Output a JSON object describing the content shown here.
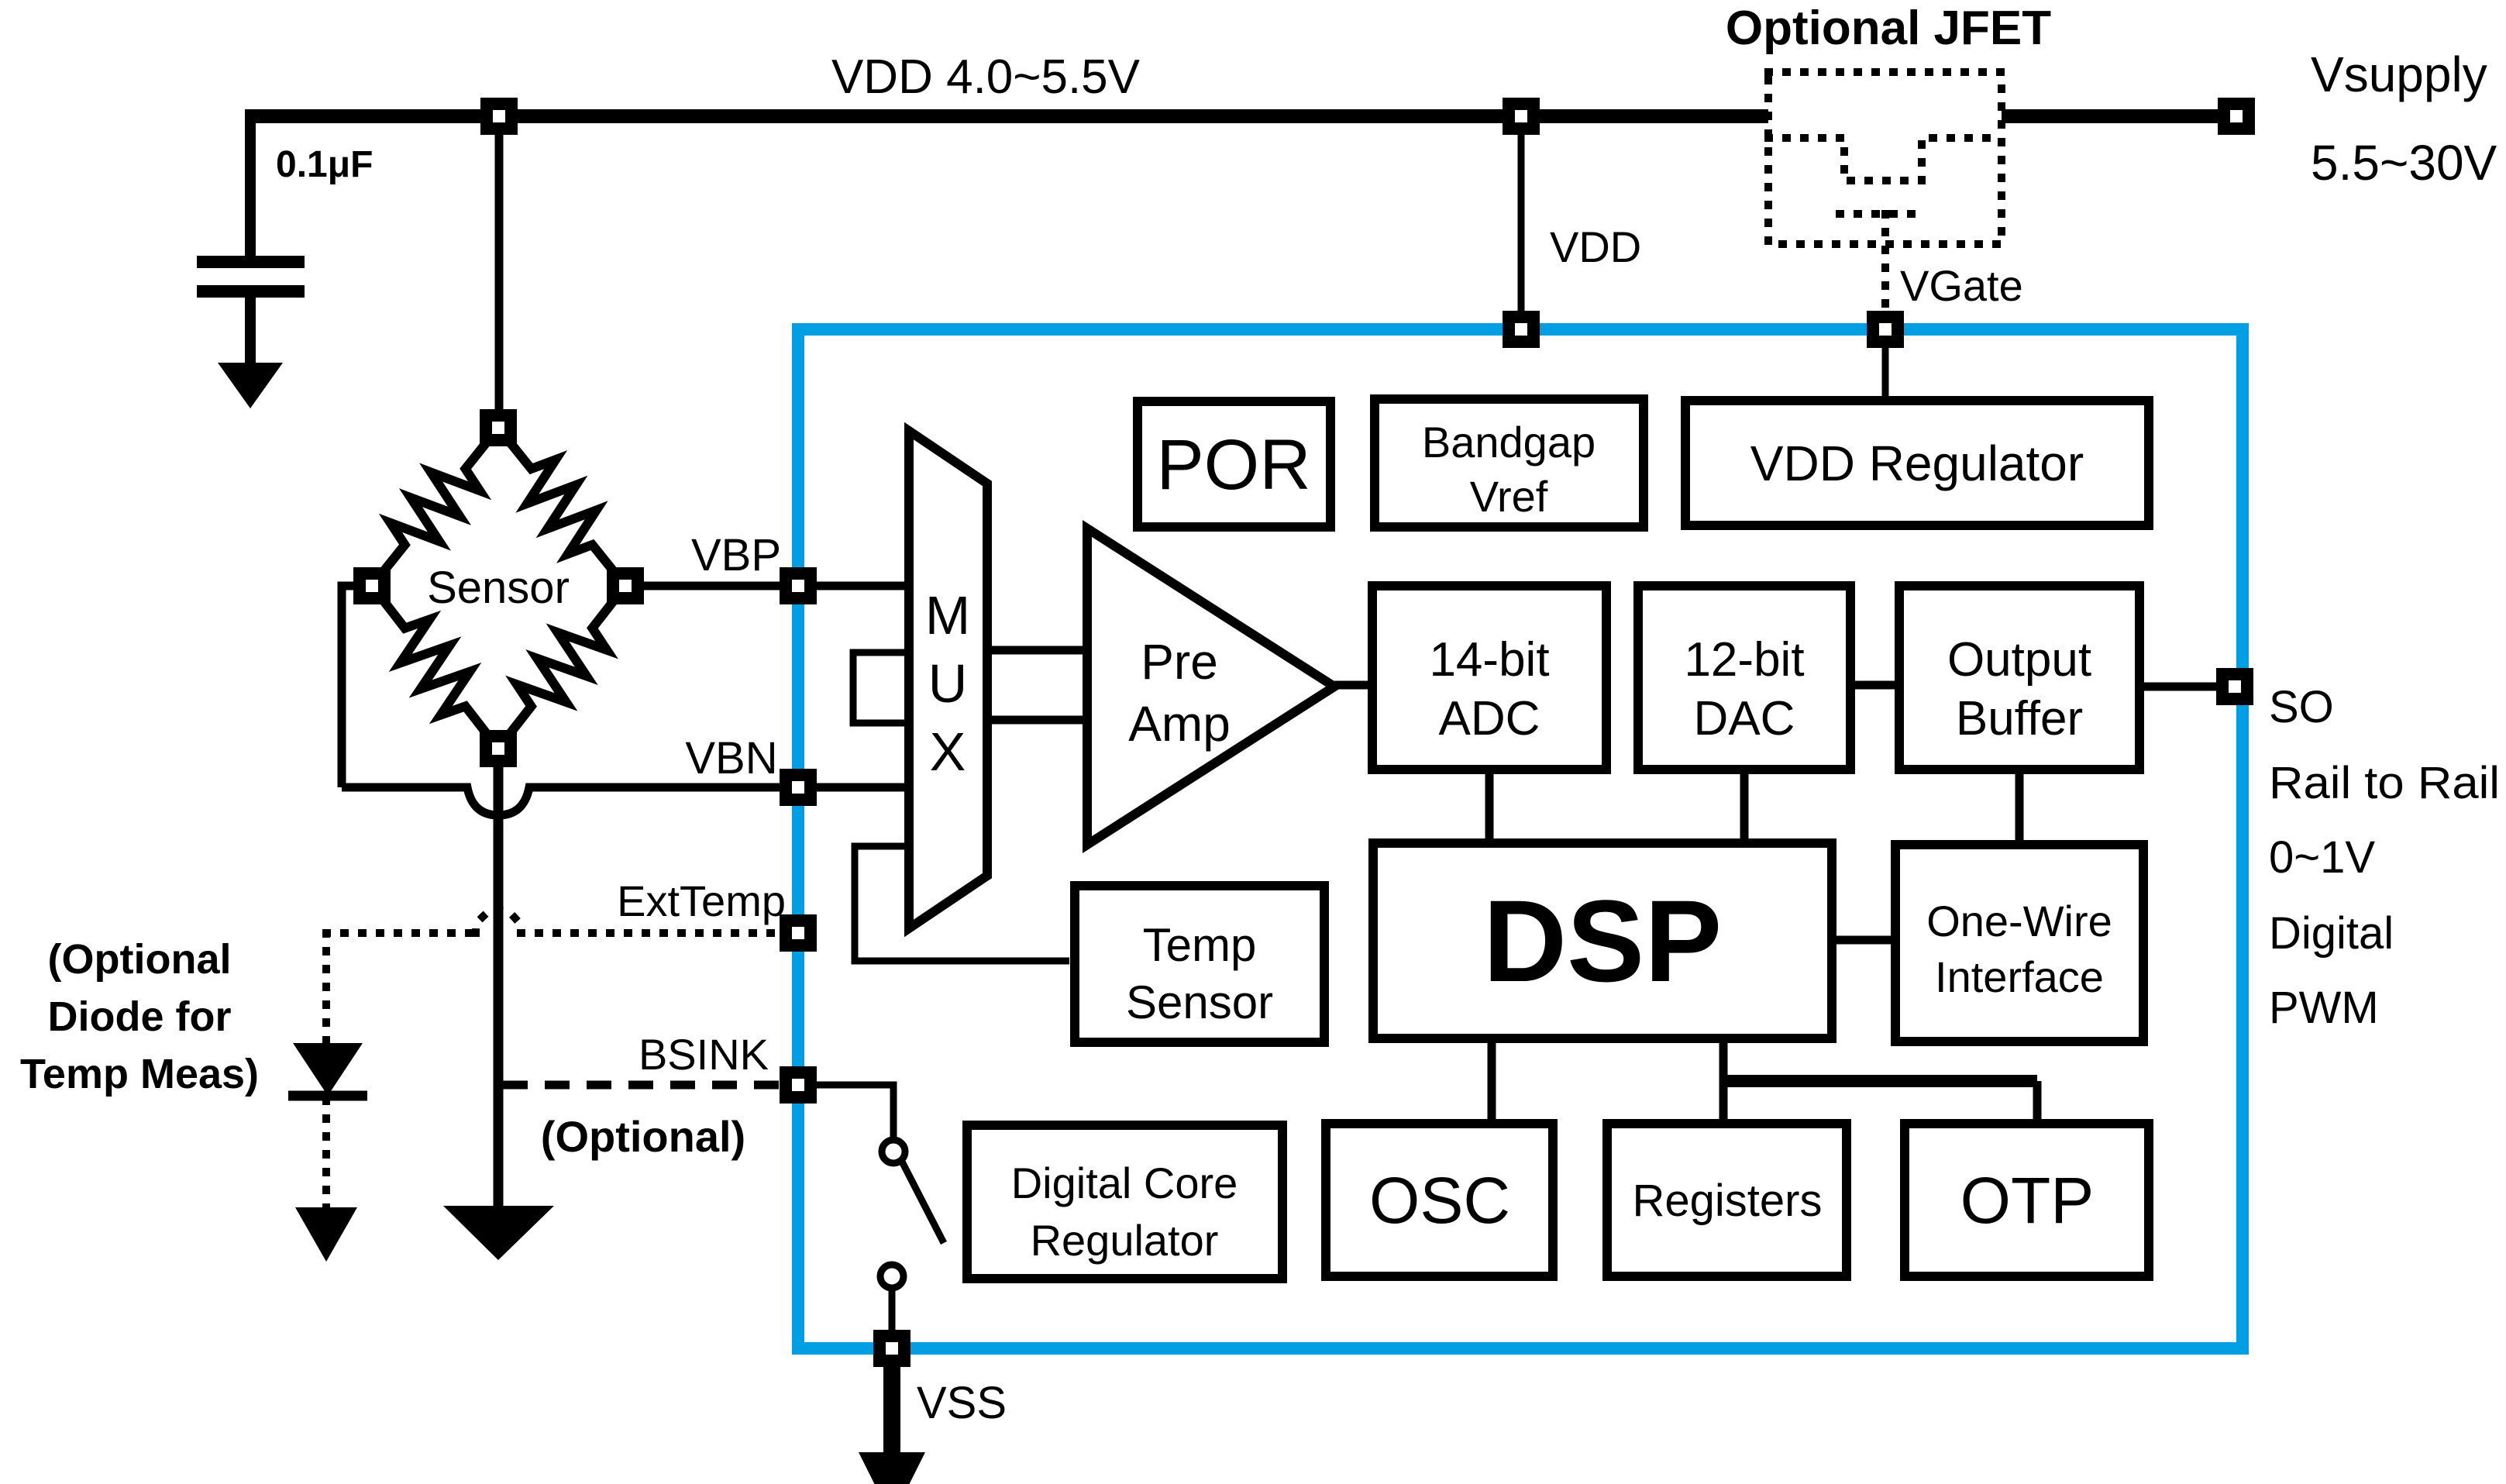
{
  "supply": {
    "rail_label": "VDD 4.0~5.5V",
    "cap_label": "0.1μF",
    "jfet_label": "Optional JFET",
    "vsupply_label": "Vsupply",
    "vsupply_range": "5.5~30V",
    "vdd_pin_label": "VDD",
    "vgate_pin_label": "VGate"
  },
  "sensor": {
    "name": "Sensor",
    "pin_vbp": "VBP",
    "pin_vbn": "VBN",
    "pin_exttemp": "ExtTemp",
    "pin_bsink": "BSINK",
    "bsink_note": "(Optional)",
    "diode_note": [
      "(Optional",
      "Diode for",
      "Temp Meas)"
    ]
  },
  "chip": {
    "accent_color": "#009fe3",
    "pin_vss": "VSS",
    "blocks": {
      "por": "POR",
      "bandgap": [
        "Bandgap",
        "Vref"
      ],
      "vdd_regulator": "VDD Regulator",
      "mux": [
        "M",
        "U",
        "X"
      ],
      "preamp": [
        "Pre",
        "Amp"
      ],
      "adc": [
        "14-bit",
        "ADC"
      ],
      "dac": [
        "12-bit",
        "DAC"
      ],
      "output_buffer": [
        "Output",
        "Buffer"
      ],
      "temp_sensor": [
        "Temp",
        "Sensor"
      ],
      "dsp": "DSP",
      "one_wire": [
        "One-Wire",
        "Interface"
      ],
      "digital_core_regulator": [
        "Digital Core",
        "Regulator"
      ],
      "osc": "OSC",
      "registers": "Registers",
      "otp": "OTP"
    }
  },
  "output": {
    "pin_so": "SO",
    "line1": "Rail to Rail",
    "line2": "0~1V",
    "line3": "Digital",
    "line4": "PWM"
  }
}
